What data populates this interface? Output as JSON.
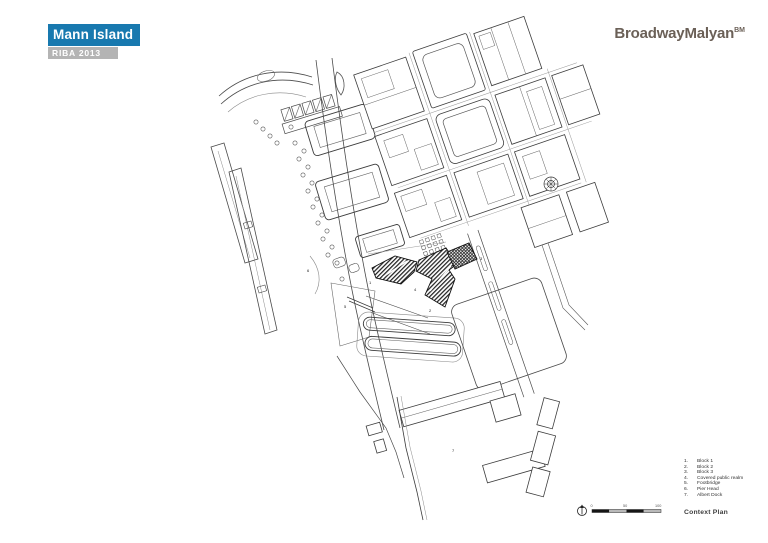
{
  "header": {
    "title": "Mann Island",
    "award": "RIBA 2013",
    "title_bg": "#1879AF",
    "award_bg": "#B4B4B4"
  },
  "brand": {
    "logo": "BroadwayMalyan",
    "logo_sup": "BM",
    "color": "#6B6057"
  },
  "legend": {
    "items": [
      {
        "num": "1.",
        "label": "Block 1"
      },
      {
        "num": "2.",
        "label": "Block 2"
      },
      {
        "num": "3.",
        "label": "Block 3"
      },
      {
        "num": "4.",
        "label": "Covered public realm"
      },
      {
        "num": "5.",
        "label": "Footbridge"
      },
      {
        "num": "6.",
        "label": "Pier Head"
      },
      {
        "num": "7.",
        "label": "Albert Dock"
      }
    ]
  },
  "footer": {
    "drawing_label": "Context Plan"
  },
  "map": {
    "callouts": [
      "1",
      "2",
      "3",
      "4",
      "5",
      "6",
      "7"
    ]
  },
  "scalebar": {
    "labels": [
      "0",
      "50",
      "100"
    ]
  }
}
